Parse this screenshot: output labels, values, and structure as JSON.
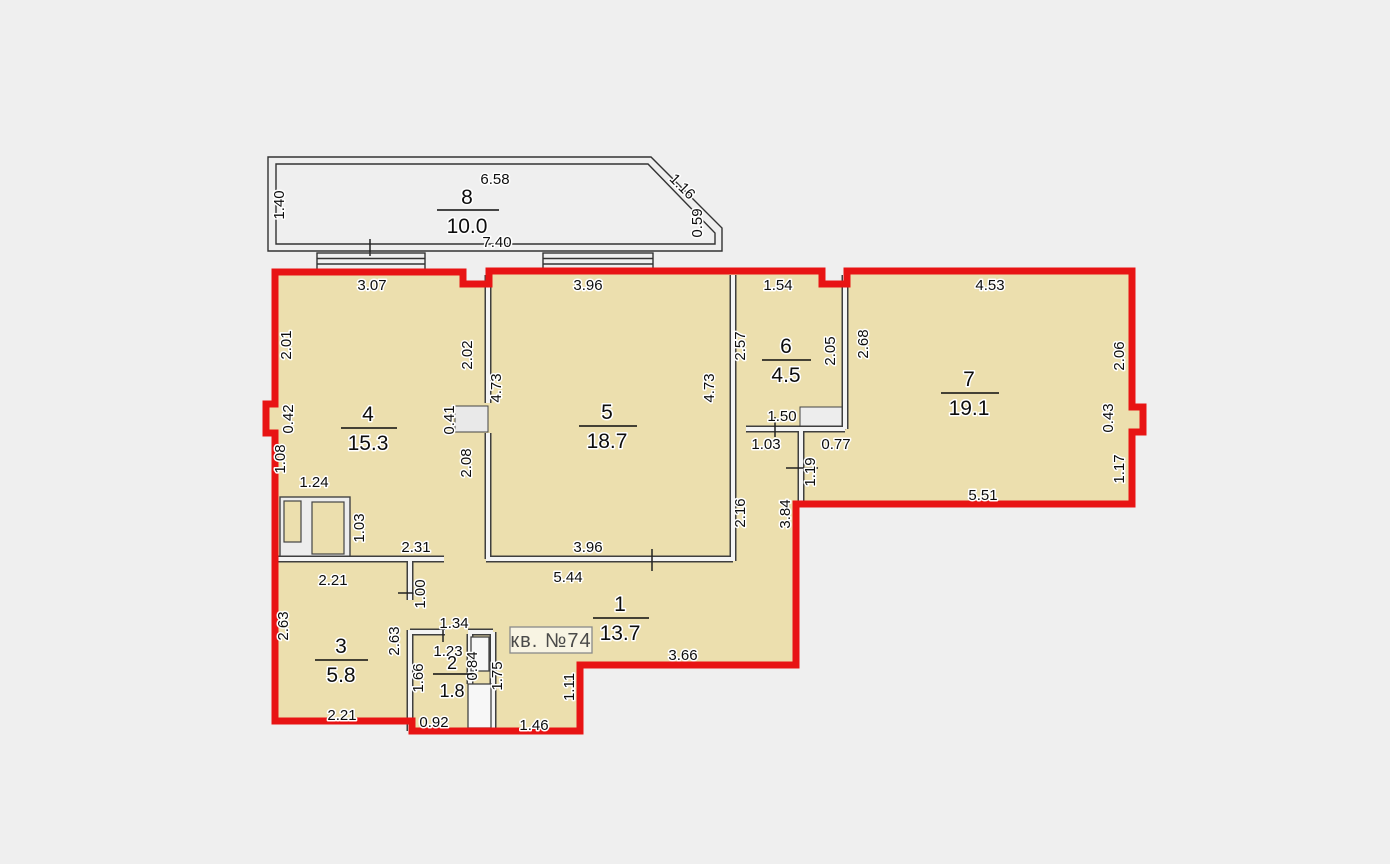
{
  "plan": {
    "apartment_label": "кв. №74",
    "rooms": {
      "r1": {
        "number": "1",
        "area": "13.7"
      },
      "r2": {
        "number": "2",
        "area": "1.8"
      },
      "r3": {
        "number": "3",
        "area": "5.8"
      },
      "r4": {
        "number": "4",
        "area": "15.3"
      },
      "r5": {
        "number": "5",
        "area": "18.7"
      },
      "r6": {
        "number": "6",
        "area": "4.5"
      },
      "r7": {
        "number": "7",
        "area": "19.1"
      },
      "r8": {
        "number": "8",
        "area": "10.0"
      }
    },
    "dims": {
      "balcony": {
        "top": "6.58",
        "bottom": "7.40",
        "left": "1.40",
        "diag": "1.16",
        "right": "0.59"
      },
      "room4": {
        "top": "3.07",
        "left_upper": "2.01",
        "left_niche": "0.42",
        "left_lower": "1.08",
        "closet": "1.24",
        "closet_side": "1.03",
        "right_upper": "2.02",
        "door": "0.41",
        "right_lower": "2.08",
        "bottom": "2.31"
      },
      "room5": {
        "top": "3.96",
        "left": "4.73",
        "right": "4.73",
        "bottom": "3.96"
      },
      "room6": {
        "top": "1.54",
        "left": "2.57",
        "right": "2.05",
        "bottom": "1.50",
        "below_left": "1.03",
        "below_right": "0.77",
        "door": "1.19"
      },
      "room7": {
        "top": "4.53",
        "left": "2.68",
        "right_upper": "2.06",
        "right_niche": "0.43",
        "right_lower": "1.17",
        "bottom": "5.51"
      },
      "room1": {
        "top": "5.44",
        "vert": "2.16",
        "right": "3.84",
        "bottom": "3.66",
        "passage": "1.00",
        "entry_height": "1.75",
        "entry_step": "1.11",
        "entry_width": "1.46"
      },
      "room3": {
        "top": "2.21",
        "left": "2.63",
        "right": "2.63",
        "bottom": "2.21"
      },
      "room2": {
        "top": "1.34",
        "width": "1.23",
        "left": "1.66",
        "shaft": "0.84",
        "bottom": "0.92"
      }
    },
    "colors": {
      "background": "#efefef",
      "room_fill": "#ecdfae",
      "outline_red": "#e81414"
    }
  }
}
